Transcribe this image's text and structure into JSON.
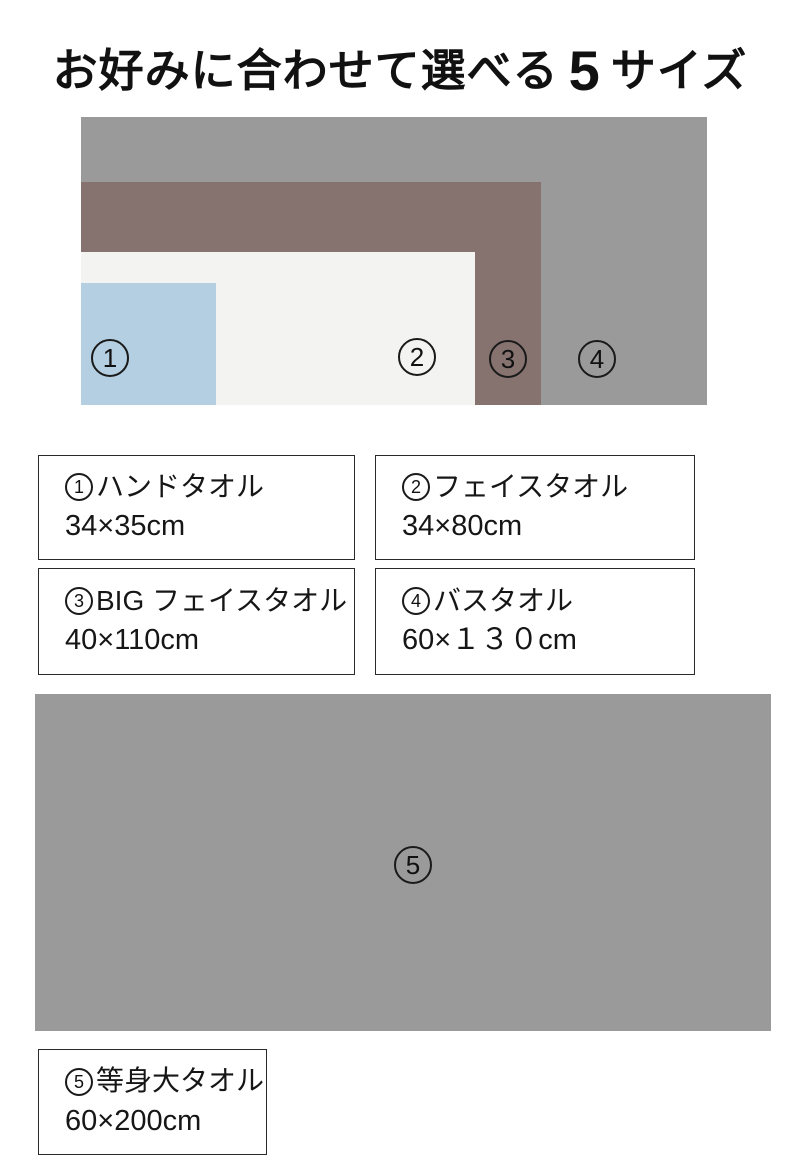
{
  "title": {
    "prefix": "お好みに合わせて選べる",
    "number": "5",
    "suffix": "サイズ"
  },
  "colors": {
    "size1_blue": "#b4cfe2",
    "size2_offwhite": "#f3f3f2",
    "size3_brown": "#867370",
    "size4_gray": "#9b9a9a",
    "size5_gray": "#9b9a9a",
    "text": "#111111",
    "box_border": "#2a2a2a"
  },
  "sizes": [
    {
      "digit": "1",
      "name": "ハンドタオル",
      "dimensions": "34×35cm"
    },
    {
      "digit": "2",
      "name": "フェイスタオル",
      "dimensions": "34×80cm"
    },
    {
      "digit": "3",
      "name": "BIG フェイスタオル",
      "dimensions": "40×110cm"
    },
    {
      "digit": "4",
      "name": "バスタオル",
      "dimensions": "60×１３０cm"
    },
    {
      "digit": "5",
      "name": "等身大タオル",
      "dimensions": "60×200cm"
    }
  ]
}
